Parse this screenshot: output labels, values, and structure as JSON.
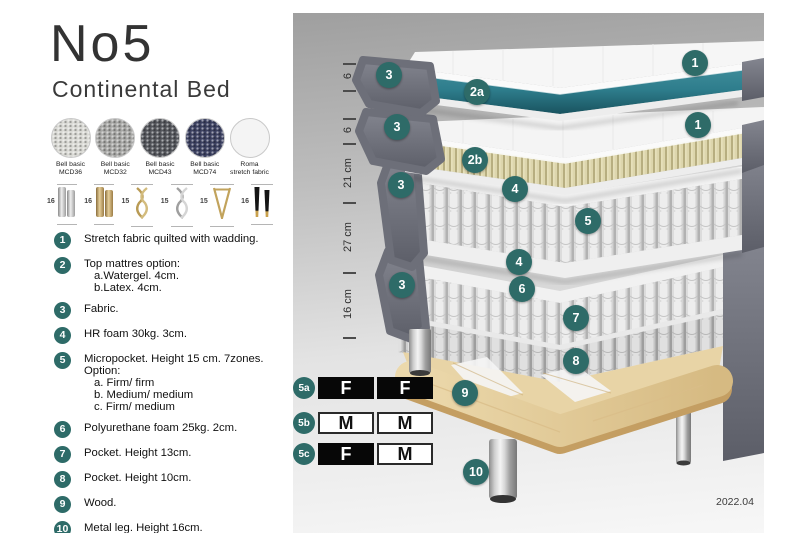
{
  "header": {
    "title": "No5",
    "subtitle": "Continental Bed"
  },
  "fabrics": [
    {
      "label_line1": "Bell basic",
      "label_line2": "MCD36",
      "color": "#d9d9d4"
    },
    {
      "label_line1": "Bell basic",
      "label_line2": "MCD32",
      "color": "#a7a7a5"
    },
    {
      "label_line1": "Bell basic",
      "label_line2": "MCD43",
      "color": "#54565c"
    },
    {
      "label_line1": "Bell basic",
      "label_line2": "MCD74",
      "color": "#3c4161"
    },
    {
      "label_line1": "Roma",
      "label_line2": "stretch fabric",
      "color": "#f4f4f4"
    }
  ],
  "legs": [
    {
      "size": "16",
      "type": "cylinder-silver"
    },
    {
      "size": "16",
      "type": "cylinder-gold"
    },
    {
      "size": "15",
      "type": "twist-gold"
    },
    {
      "size": "15",
      "type": "twist-silver"
    },
    {
      "size": "15",
      "type": "hairpin-gold"
    },
    {
      "size": "16",
      "type": "tapered-black-gold"
    }
  ],
  "spec_items": [
    {
      "num": "1",
      "lines": [
        "Stretch fabric quilted with wadding."
      ]
    },
    {
      "num": "2",
      "lines": [
        "Top mattres option:",
        "a.Watergel. 4cm.",
        "b.Latex. 4cm."
      ]
    },
    {
      "num": "3",
      "lines": [
        "Fabric."
      ]
    },
    {
      "num": "4",
      "lines": [
        "HR foam 30kg. 3cm."
      ]
    },
    {
      "num": "5",
      "lines": [
        "Micropocket. Height 15 cm. 7zones. Option:",
        "a. Firm/ firm",
        "b. Medium/ medium",
        "c. Firm/ medium"
      ]
    },
    {
      "num": "6",
      "lines": [
        "Polyurethane foam 25kg. 2cm."
      ]
    },
    {
      "num": "7",
      "lines": [
        "Pocket. Height 13cm."
      ]
    },
    {
      "num": "8",
      "lines": [
        "Pocket. Height 10cm."
      ]
    },
    {
      "num": "9",
      "lines": [
        "Wood."
      ]
    },
    {
      "num": "10",
      "lines": [
        "Metal leg. Height 16cm."
      ]
    }
  ],
  "diagram": {
    "dimensions": [
      {
        "label": "6"
      },
      {
        "label": "6"
      },
      {
        "label": "21 cm"
      },
      {
        "label": "27 cm"
      },
      {
        "label": "16 cm"
      }
    ],
    "callouts": [
      {
        "label": "1"
      },
      {
        "label": "3"
      },
      {
        "label": "2a"
      },
      {
        "label": "3"
      },
      {
        "label": "2b"
      },
      {
        "label": "1"
      },
      {
        "label": "4"
      },
      {
        "label": "5"
      },
      {
        "label": "3"
      },
      {
        "label": "4"
      },
      {
        "label": "6"
      },
      {
        "label": "7"
      },
      {
        "label": "3"
      },
      {
        "label": "8"
      },
      {
        "label": "9"
      },
      {
        "label": "10"
      }
    ],
    "version": "2022.04"
  },
  "firmness_options": [
    {
      "id": "5a",
      "cells": [
        {
          "label": "F"
        },
        {
          "label": "F"
        }
      ]
    },
    {
      "id": "5b",
      "cells": [
        {
          "label": "M"
        },
        {
          "label": "M"
        }
      ]
    },
    {
      "id": "5c",
      "cells": [
        {
          "label": "F"
        },
        {
          "label": "M"
        }
      ]
    }
  ],
  "colors": {
    "accent_teal": "#2e6b68",
    "watergel_teal": "#2f7f8e",
    "latex_cream": "#ddd6ad",
    "fabric_gray": "#70727c",
    "wood": "#e2cb9b",
    "metal": "#c9c9c9"
  }
}
